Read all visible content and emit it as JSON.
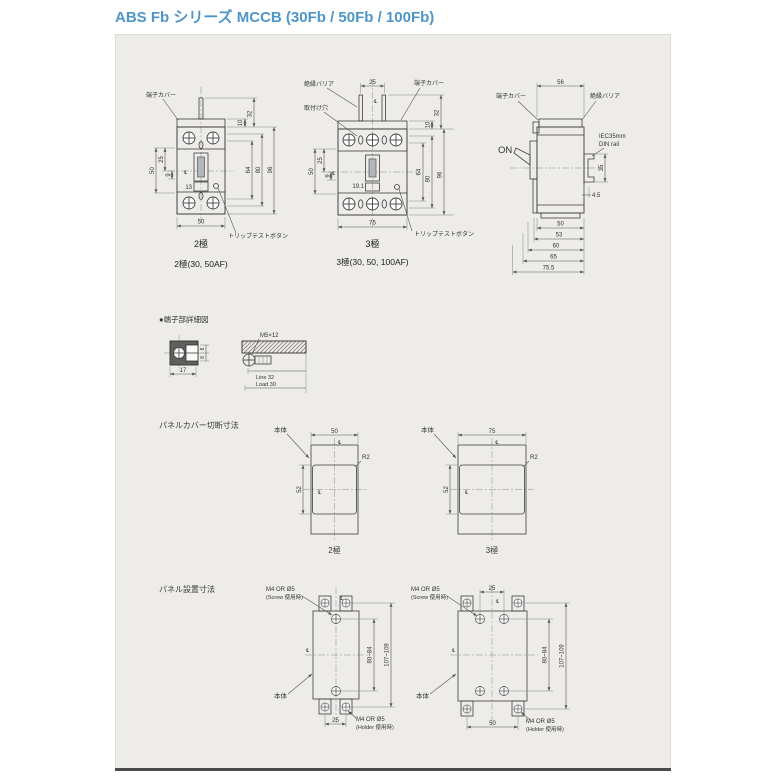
{
  "title": "ABS Fb シリーズ MCCB (30Fb / 50Fb / 100Fb)",
  "labels": {
    "terminal_cover": "端子カバー",
    "insulation_barrier": "絶縁バリア",
    "mounting_hole": "取付け穴",
    "trip_test_button": "トリップテストボタン",
    "on": "ON",
    "din_line1": "IEC35mm",
    "din_line2": "DIN rail",
    "body": "本体",
    "centerline": "℄"
  },
  "front2p": {
    "dims": {
      "cover_h": "10",
      "top_h": "32",
      "h_inner": "64",
      "h_mid": "80",
      "h_total": "96",
      "left_total": "50",
      "left_upper": "25",
      "left_lower": "9",
      "handle_w": "13",
      "width": "50"
    },
    "caption": "2極",
    "subcaption": "2極(30, 50AF)"
  },
  "front3p": {
    "dims": {
      "pole_pitch": "25",
      "cover_h": "10",
      "top_h": "32",
      "h_inner": "64",
      "h_mid": "80",
      "h_total": "96",
      "left_total": "50",
      "left_upper": "25",
      "left_lower": "9",
      "handle_w": "19.1",
      "width": "75"
    },
    "caption": "3極",
    "subcaption": "3極(30, 50, 100AF)"
  },
  "side": {
    "dims": {
      "depth": "56",
      "rail_height": "35",
      "rail_offset": "4.5",
      "d1": "50",
      "d2": "53",
      "d3": "60",
      "d4": "65",
      "d5": "75.5"
    }
  },
  "terminal_detail": {
    "title": "●端子部詳細図",
    "screw_spec": "M5×12",
    "dims": {
      "width": "17",
      "height_top": "8",
      "height_bottom": "8",
      "line_side": "Line 32",
      "load_side": "Load 30"
    }
  },
  "panel_cut": {
    "title": "パネルカバー切断寸法",
    "p2": {
      "width": "50",
      "height": "52",
      "radius": "R2",
      "caption": "2極"
    },
    "p3": {
      "width": "75",
      "height": "52",
      "radius": "R2",
      "caption": "3極"
    }
  },
  "panel_install": {
    "title": "パネル設置寸法",
    "screw_label": "M4 OR Ø5",
    "screw_note": "(Screw 使用時)",
    "holder_label": "M4 OR Ø5",
    "holder_note": "(Holder 使用時)",
    "p2": {
      "hole_pitch_x": "25",
      "hole_pitch_y": "80~84",
      "foot_pitch_y": "107~109"
    },
    "p3": {
      "hole_pitch_x": "25",
      "foot_pitch_x": "50",
      "hole_pitch_y": "80~84",
      "foot_pitch_y": "107~109"
    }
  }
}
